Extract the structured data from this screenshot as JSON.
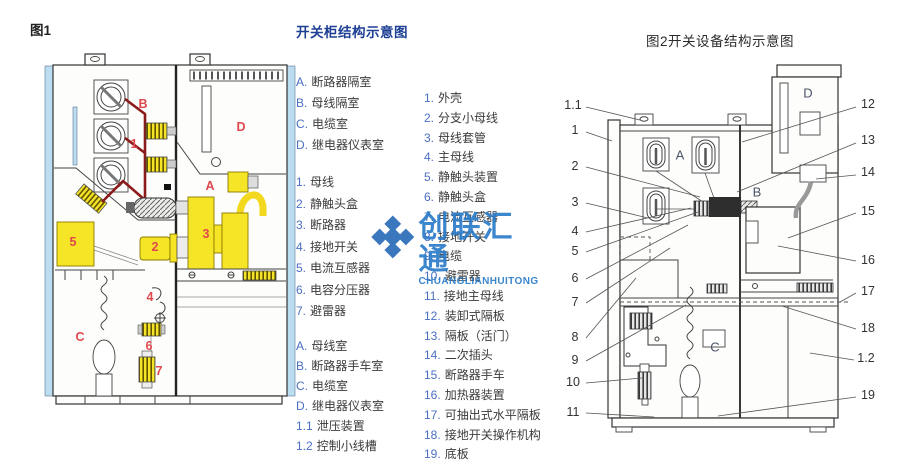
{
  "figure1": {
    "caption": "图1",
    "labels": [
      {
        "text": "B",
        "x": 103,
        "y": 54
      },
      {
        "text": "1",
        "x": 94,
        "y": 94
      },
      {
        "text": "D",
        "x": 201,
        "y": 77
      },
      {
        "text": "A",
        "x": 170,
        "y": 136
      },
      {
        "text": "3",
        "x": 166,
        "y": 184
      },
      {
        "text": "2",
        "x": 115,
        "y": 197
      },
      {
        "text": "5",
        "x": 33,
        "y": 192
      },
      {
        "text": "4",
        "x": 110,
        "y": 247
      },
      {
        "text": "C",
        "x": 40,
        "y": 287
      },
      {
        "text": "6",
        "x": 109,
        "y": 296
      },
      {
        "text": "7",
        "x": 119,
        "y": 321
      }
    ]
  },
  "legend": {
    "title": "开关柜结构示意图",
    "fig1_compartments": [
      {
        "key": "A.",
        "label": "断路器隔室"
      },
      {
        "key": "B.",
        "label": "母线隔室"
      },
      {
        "key": "C.",
        "label": "电缆室"
      },
      {
        "key": "D.",
        "label": "继电器仪表室"
      }
    ],
    "fig1_parts": [
      {
        "key": "1.",
        "label": "母线"
      },
      {
        "key": "2.",
        "label": "静触头盒"
      },
      {
        "key": "3.",
        "label": "断路器"
      },
      {
        "key": "4.",
        "label": "接地开关"
      },
      {
        "key": "5.",
        "label": "电流互感器"
      },
      {
        "key": "6.",
        "label": "电容分压器"
      },
      {
        "key": "7.",
        "label": "避雷器"
      }
    ],
    "fig2_compartments": [
      {
        "key": "A.",
        "label": "母线室"
      },
      {
        "key": "B.",
        "label": "断路器手车室"
      },
      {
        "key": "C.",
        "label": "电缆室"
      },
      {
        "key": "D.",
        "label": "继电器仪表室"
      },
      {
        "key": "1.1",
        "label": "泄压装置"
      },
      {
        "key": "1.2",
        "label": "控制小线槽"
      }
    ],
    "fig2_parts": [
      {
        "key": "1.",
        "label": "外壳"
      },
      {
        "key": "2.",
        "label": "分支小母线"
      },
      {
        "key": "3.",
        "label": "母线套管"
      },
      {
        "key": "4.",
        "label": "主母线"
      },
      {
        "key": "5.",
        "label": "静触头装置"
      },
      {
        "key": "6.",
        "label": "静触头盒"
      },
      {
        "key": "7.",
        "label": "电流互感器"
      },
      {
        "key": "8.",
        "label": "接地开关"
      },
      {
        "key": "9.",
        "label": "电缆"
      },
      {
        "key": "10.",
        "label": "避雷器"
      },
      {
        "key": "11.",
        "label": "接地主母线"
      },
      {
        "key": "12.",
        "label": "装卸式隔板"
      },
      {
        "key": "13.",
        "label": "隔板（活门）"
      },
      {
        "key": "14.",
        "label": "二次插头"
      },
      {
        "key": "15.",
        "label": "断路器手车"
      },
      {
        "key": "16.",
        "label": "加热器装置"
      },
      {
        "key": "17.",
        "label": "可抽出式水平隔板"
      },
      {
        "key": "18.",
        "label": "接地开关操作机构"
      },
      {
        "key": "19.",
        "label": "底板"
      }
    ]
  },
  "figure2": {
    "caption": "图2开关设备结构示意图",
    "region_labels": [
      {
        "text": "A",
        "x": 132,
        "y": 100
      },
      {
        "text": "B",
        "x": 209,
        "y": 137
      },
      {
        "text": "C",
        "x": 167,
        "y": 292
      },
      {
        "text": "D",
        "x": 260,
        "y": 38
      }
    ],
    "callouts_left": [
      {
        "text": "1.1",
        "x": 25,
        "y": 50
      },
      {
        "text": "1",
        "x": 27,
        "y": 75
      },
      {
        "text": "2",
        "x": 27,
        "y": 111
      },
      {
        "text": "3",
        "x": 27,
        "y": 147
      },
      {
        "text": "4",
        "x": 27,
        "y": 176
      },
      {
        "text": "5",
        "x": 27,
        "y": 196
      },
      {
        "text": "6",
        "x": 27,
        "y": 223
      },
      {
        "text": "7",
        "x": 27,
        "y": 247
      },
      {
        "text": "8",
        "x": 27,
        "y": 282
      },
      {
        "text": "9",
        "x": 27,
        "y": 305
      },
      {
        "text": "10",
        "x": 25,
        "y": 327
      },
      {
        "text": "11",
        "x": 25,
        "y": 357
      }
    ],
    "callouts_right": [
      {
        "text": "12",
        "x": 320,
        "y": 49
      },
      {
        "text": "13",
        "x": 320,
        "y": 85
      },
      {
        "text": "14",
        "x": 320,
        "y": 117
      },
      {
        "text": "15",
        "x": 320,
        "y": 156
      },
      {
        "text": "16",
        "x": 320,
        "y": 205
      },
      {
        "text": "17",
        "x": 320,
        "y": 236
      },
      {
        "text": "18",
        "x": 320,
        "y": 273
      },
      {
        "text": "1.2",
        "x": 318,
        "y": 303
      },
      {
        "text": "19",
        "x": 320,
        "y": 340
      }
    ]
  },
  "watermark": {
    "text": "创联汇通",
    "subtext": "CHUANGLIANHUITONG"
  },
  "colors": {
    "legend_title_blue": "#1d3f94",
    "legend_key_blue": "#4a6fc3",
    "fig1_label_red": "#e0484e",
    "busbar_dark_red": "#8c1a1a",
    "highlight_yellow": "#f6e426",
    "panel_light_blue": "#bcdcf0",
    "watermark_blue": "#2b7cc9"
  }
}
